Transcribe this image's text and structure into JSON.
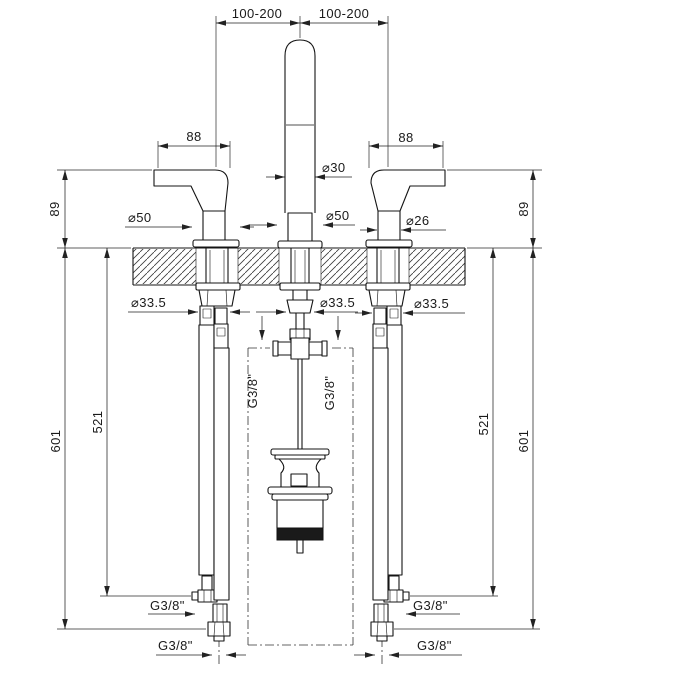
{
  "drawing": {
    "kind": "technical-dimension-drawing",
    "subject": "3-hole widespread basin mixer with lever handles, flexible supply hoses and pop-up waste",
    "colors": {
      "line": "#1a1a1a",
      "background": "#ffffff",
      "grip": "#1c1c1c"
    },
    "dims": {
      "top_span_left": "100-200",
      "top_span_right": "100-200",
      "handle_length_left": "88",
      "handle_length_right": "88",
      "height_above_deck_left": "89",
      "height_above_deck_right": "89",
      "spout_diameter": "⌀30",
      "spout_flange_diameter": "⌀50",
      "handle_flange_diameter": "⌀50",
      "handle_grip_diameter": "⌀26",
      "deck_hole_left": "⌀33.5",
      "deck_hole_center": "⌀33.5",
      "deck_hole_right": "⌀33.5",
      "hose_length_short_left": "521",
      "hose_length_long_left": "601",
      "hose_length_short_right": "521",
      "hose_length_long_right": "601",
      "tee_thread_left": "G3/8\"",
      "tee_thread_right": "G3/8\"",
      "elbow_thread_left": "G3/8\"",
      "elbow_thread_right": "G3/8\"",
      "supply_thread_left": "G3/8\"",
      "supply_thread_right": "G3/8\""
    }
  }
}
